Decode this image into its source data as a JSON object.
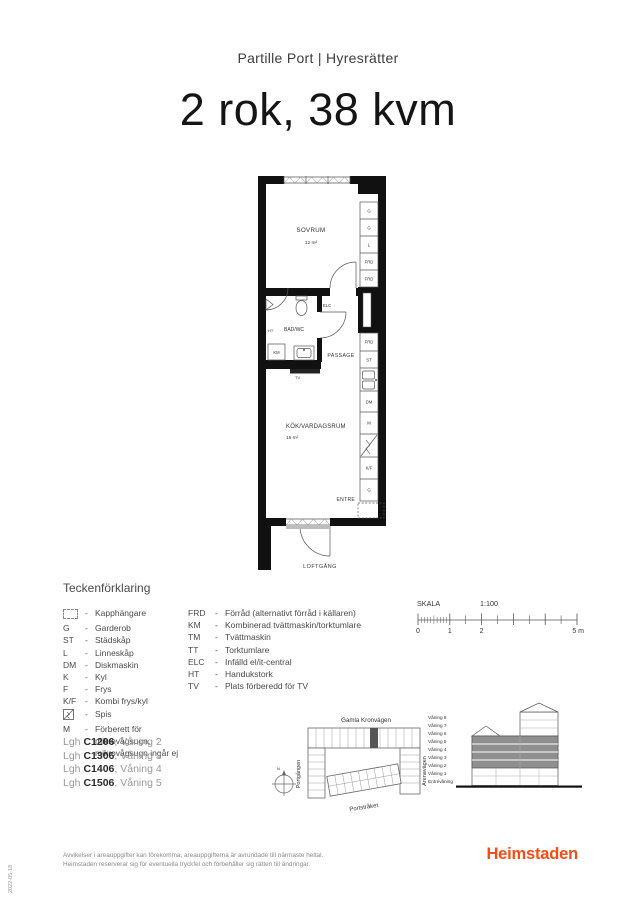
{
  "header": {
    "project": "Partille Port | Hyresrätter",
    "title": "2 rok, 38 kvm"
  },
  "plan": {
    "bedroom_name": "SOVRUM",
    "bedroom_area": "12 m²",
    "kitchen_name": "KÖK/VARDAGSRUM",
    "kitchen_area": "15 m²",
    "bathroom": "BAD/WC",
    "passage": "PASSAGE",
    "entry": "ENTRE",
    "walkway": "LOFTGÅNG",
    "elc": "ELC",
    "ht": "HT",
    "km": "KM",
    "tv": "TV",
    "closets": [
      "G",
      "G",
      "L",
      "FRD",
      "FRD"
    ],
    "column": [
      "FRD",
      "ST",
      "DM",
      "M",
      "K/F",
      "G"
    ]
  },
  "legend": {
    "title": "Teckenförklaring",
    "dash": "-",
    "left": [
      {
        "abbr": "",
        "desc": "Kapphängare"
      },
      {
        "abbr": "G",
        "desc": "Garderob"
      },
      {
        "abbr": "ST",
        "desc": "Städskåp"
      },
      {
        "abbr": "L",
        "desc": "Linneskåp"
      },
      {
        "abbr": "DM",
        "desc": "Diskmaskin"
      },
      {
        "abbr": "K",
        "desc": "Kyl"
      },
      {
        "abbr": "F",
        "desc": "Frys"
      },
      {
        "abbr": "K/F",
        "desc": "Kombi frys/kyl"
      },
      {
        "abbr": "",
        "desc": "Spis"
      },
      {
        "abbr": "M",
        "desc": "Förberett för mikrovågsugn, mikrovågsugn ingår ej"
      }
    ],
    "right": [
      {
        "abbr": "FRD",
        "desc": "Förråd (alternativt förråd i källaren)"
      },
      {
        "abbr": "KM",
        "desc": "Kombinerad tvättmaskin/torktumlare"
      },
      {
        "abbr": "TM",
        "desc": "Tvättmaskin"
      },
      {
        "abbr": "TT",
        "desc": "Torktumlare"
      },
      {
        "abbr": "ELC",
        "desc": "Infälld el/it-central"
      },
      {
        "abbr": "HT",
        "desc": "Handukstork"
      },
      {
        "abbr": "TV",
        "desc": "Plats förberedd för TV"
      }
    ]
  },
  "scale": {
    "label": "SKALA",
    "ratio": "1:100",
    "tick0": "0",
    "tick1": "1",
    "tick2": "2",
    "tick5": "5 m"
  },
  "apartments": [
    {
      "prefix": "Lgh ",
      "code": "C1206",
      "rest": ", Våning 2"
    },
    {
      "prefix": "Lgh ",
      "code": "C1306",
      "rest": ", Våning 3"
    },
    {
      "prefix": "Lgh ",
      "code": "C1406",
      "rest": ", Våning 4"
    },
    {
      "prefix": "Lgh ",
      "code": "C1506",
      "rest": ", Våning 5"
    }
  ],
  "sitemap": {
    "street_top": "Gamla Kronvägen",
    "street_left": "Portgången",
    "street_right": "Arenavägen",
    "street_bottom": "Portstråket",
    "compass": "N",
    "unit_fill": "#555555"
  },
  "elevation": {
    "floors": [
      "Våning 8",
      "Våning 7",
      "Våning 6",
      "Våning 5",
      "Våning 4",
      "Våning 3",
      "Våning 2",
      "Våning 1",
      "Entrévåning"
    ],
    "highlight_fill": "#8f8f8f"
  },
  "footer": {
    "disclaimer1": "Avvikelser i areauppgifter kan förekomma, areauppgifterna är avrundade till närmaste heltal.",
    "disclaimer2": "Heimstaden reserverar sig för eventuella tryckfel och förbehåller sig rätten till ändringar.",
    "brand": "Heimstaden",
    "brand_color": "#F84C15"
  },
  "meta_date": "2022-05-18"
}
